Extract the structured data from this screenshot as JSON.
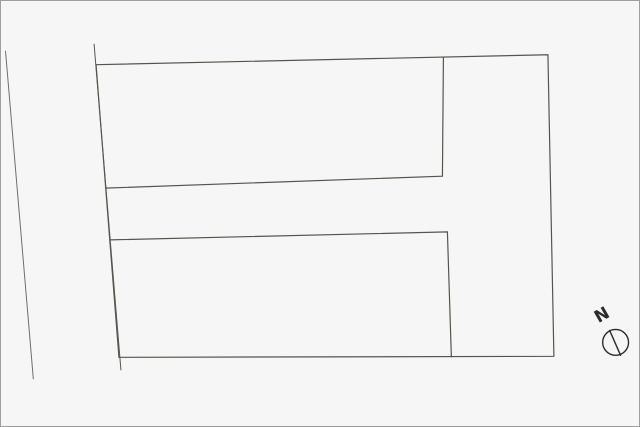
{
  "canvas": {
    "width": 640,
    "height": 427,
    "background": "#f6f6f6",
    "frame_color": "#9e9e9e"
  },
  "colors": {
    "parcel_fill": "#e1e9bd",
    "boundary_line": "#55554b",
    "road_line": "#6e6e6e",
    "compass": "#2b2b2b"
  },
  "shapes": {
    "road_edge_line": {
      "d": "M 4 50 L 32 380"
    },
    "left_boundary_line": {
      "d": "M 93 43 L 120 371"
    },
    "outer_boundary": {
      "points": "95,64 549,54 555,357 118,358"
    },
    "upper_parcel_divider": {
      "points": "444,56 443,176 104,188"
    },
    "lower_parcel_divider": {
      "points": "109,240 448,232 452,358"
    }
  },
  "compass": {
    "label": "N",
    "label_x": 603,
    "label_y": 321,
    "label_transform": "rotate(-30 603 315)",
    "cx": 617,
    "cy": 343,
    "r": 13,
    "needle_d": "M 611 331 L 622 356"
  }
}
